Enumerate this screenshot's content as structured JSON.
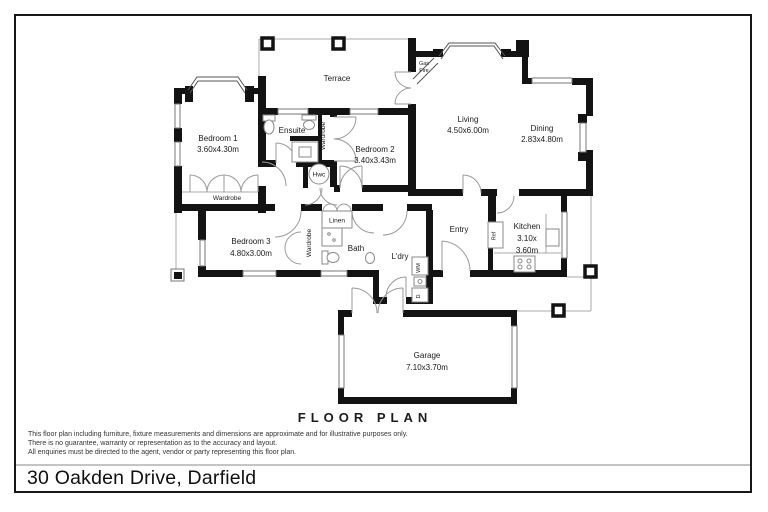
{
  "page": {
    "floor_plan_title": "FLOOR PLAN",
    "address": "30 Oakden Drive, Darfield",
    "disclaimer_line1": "This floor plan including furniture, fixture measurements and dimensions are approximate and for illustrative purposes only.",
    "disclaimer_line2": "There is no guarantee, warranty or representation as to the accuracy and layout.",
    "disclaimer_line3": "All enquiries must be directed to the agent, vendor or party representing this floor plan."
  },
  "colors": {
    "wall": "#131313",
    "ink": "#1a1a1a",
    "separator_line": "#c4c4c4"
  },
  "rooms": {
    "terrace": {
      "name": "Terrace"
    },
    "bedroom1": {
      "name": "Bedroom 1",
      "dims": "3.60x4.30m"
    },
    "ensuite": {
      "name": "Ensuite"
    },
    "bedroom2": {
      "name": "Bedroom 2",
      "dims": "3.40x3.43m"
    },
    "living": {
      "name": "Living",
      "dims": "4.50x6.00m"
    },
    "dining": {
      "name": "Dining",
      "dims": "2.83x4.80m"
    },
    "gas_fire": {
      "line1": "Gas",
      "line2": "Fire"
    },
    "hwc": {
      "name": "Hwc"
    },
    "wardrobe_bed1": {
      "name": "Wardrobe"
    },
    "wardrobe_bed2": {
      "name": "Wardrobe"
    },
    "wardrobe_bed3": {
      "name": "Wardrobe"
    },
    "bedroom3": {
      "name": "Bedroom 3",
      "dims": "4.80x3.00m"
    },
    "linen": {
      "name": "Linen"
    },
    "bath": {
      "name": "Bath"
    },
    "laundry": {
      "name": "L'dry"
    },
    "washing_machine": {
      "name": "WM"
    },
    "dryer": {
      "name": "D"
    },
    "entry": {
      "name": "Entry"
    },
    "ref": {
      "name": "Ref"
    },
    "kitchen": {
      "name": "Kitchen",
      "dims_line1": "3.10x",
      "dims_line2": "3.60m"
    },
    "garage": {
      "name": "Garage",
      "dims": "7.10x3.70m"
    }
  }
}
